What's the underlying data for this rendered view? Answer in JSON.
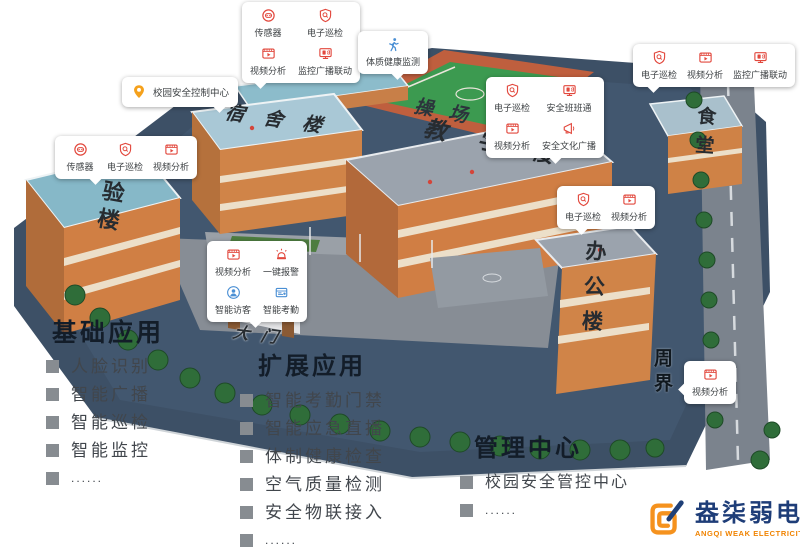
{
  "scene": {
    "buildings": {
      "experiment": "实验楼",
      "dormitory": "宿舍楼",
      "teaching": "教学楼",
      "office": "办公楼",
      "canteen": "食堂",
      "playground": "操场",
      "gate": "大门",
      "perimeter": "周界"
    }
  },
  "callouts": {
    "sensor_top": {
      "items": [
        {
          "icon": "sensor-icon",
          "label": "传感器"
        },
        {
          "icon": "shield-patrol-icon",
          "label": "电子巡检"
        },
        {
          "icon": "video-analysis-icon",
          "label": "视频分析"
        },
        {
          "icon": "broadcast-monitor-icon",
          "label": "监控广播联动"
        }
      ]
    },
    "health": {
      "icon": "runner-icon",
      "label": "体质健康监测"
    },
    "top_right": {
      "items": [
        {
          "icon": "shield-patrol-icon",
          "label": "电子巡检"
        },
        {
          "icon": "video-analysis-icon",
          "label": "视频分析"
        },
        {
          "icon": "broadcast-monitor-icon",
          "label": "监控广播联动"
        }
      ]
    },
    "control_center": {
      "icon": "location-pin-icon",
      "label": "校园安全控制中心"
    },
    "lab_left": {
      "items": [
        {
          "icon": "sensor-icon",
          "label": "传感器"
        },
        {
          "icon": "shield-patrol-icon",
          "label": "电子巡检"
        },
        {
          "icon": "video-analysis-icon",
          "label": "视频分析"
        }
      ]
    },
    "playground_side": {
      "items": [
        {
          "icon": "shield-patrol-icon",
          "label": "电子巡检"
        },
        {
          "icon": "class-monitor-icon",
          "label": "安全班班通"
        },
        {
          "icon": "video-analysis-icon",
          "label": "视频分析"
        },
        {
          "icon": "megaphone-icon",
          "label": "安全文化广播"
        }
      ]
    },
    "gate_area": {
      "items": [
        {
          "icon": "video-analysis-icon",
          "label": "视频分析"
        },
        {
          "icon": "alarm-icon",
          "label": "一键报警"
        },
        {
          "icon": "visitor-icon",
          "label": "智能访客"
        },
        {
          "icon": "attendance-icon",
          "label": "智能考勤"
        }
      ]
    },
    "office_side": {
      "items": [
        {
          "icon": "shield-patrol-icon",
          "label": "电子巡检"
        },
        {
          "icon": "video-analysis-icon",
          "label": "视频分析"
        }
      ]
    },
    "perimeter_cam": {
      "items": [
        {
          "icon": "video-analysis-icon",
          "label": "视频分析"
        }
      ]
    }
  },
  "lists": {
    "basic": {
      "title": "基础应用",
      "items": [
        "人脸识别",
        "智能广播",
        "智能巡检",
        "智能监控",
        "......"
      ]
    },
    "extended": {
      "title": "扩展应用",
      "items": [
        "智能考勤门禁",
        "智能应急直播",
        "体制健康检查",
        "空气质量检测",
        "安全物联接入",
        "......"
      ]
    },
    "management": {
      "title": "管理中心",
      "items": [
        "校园安全管控中心",
        "......"
      ]
    }
  },
  "logo": {
    "name": "盎柒弱电",
    "subtitle": "ANGQI WEAK ELECTRICITY"
  },
  "colors": {
    "icon_red": "#e2483d",
    "icon_blue": "#4a8fd4",
    "icon_orange": "#f5a11c",
    "title": "#131d29",
    "list_text": "#41464c",
    "logo_blue": "#1e3d78",
    "logo_orange": "#f08300"
  }
}
